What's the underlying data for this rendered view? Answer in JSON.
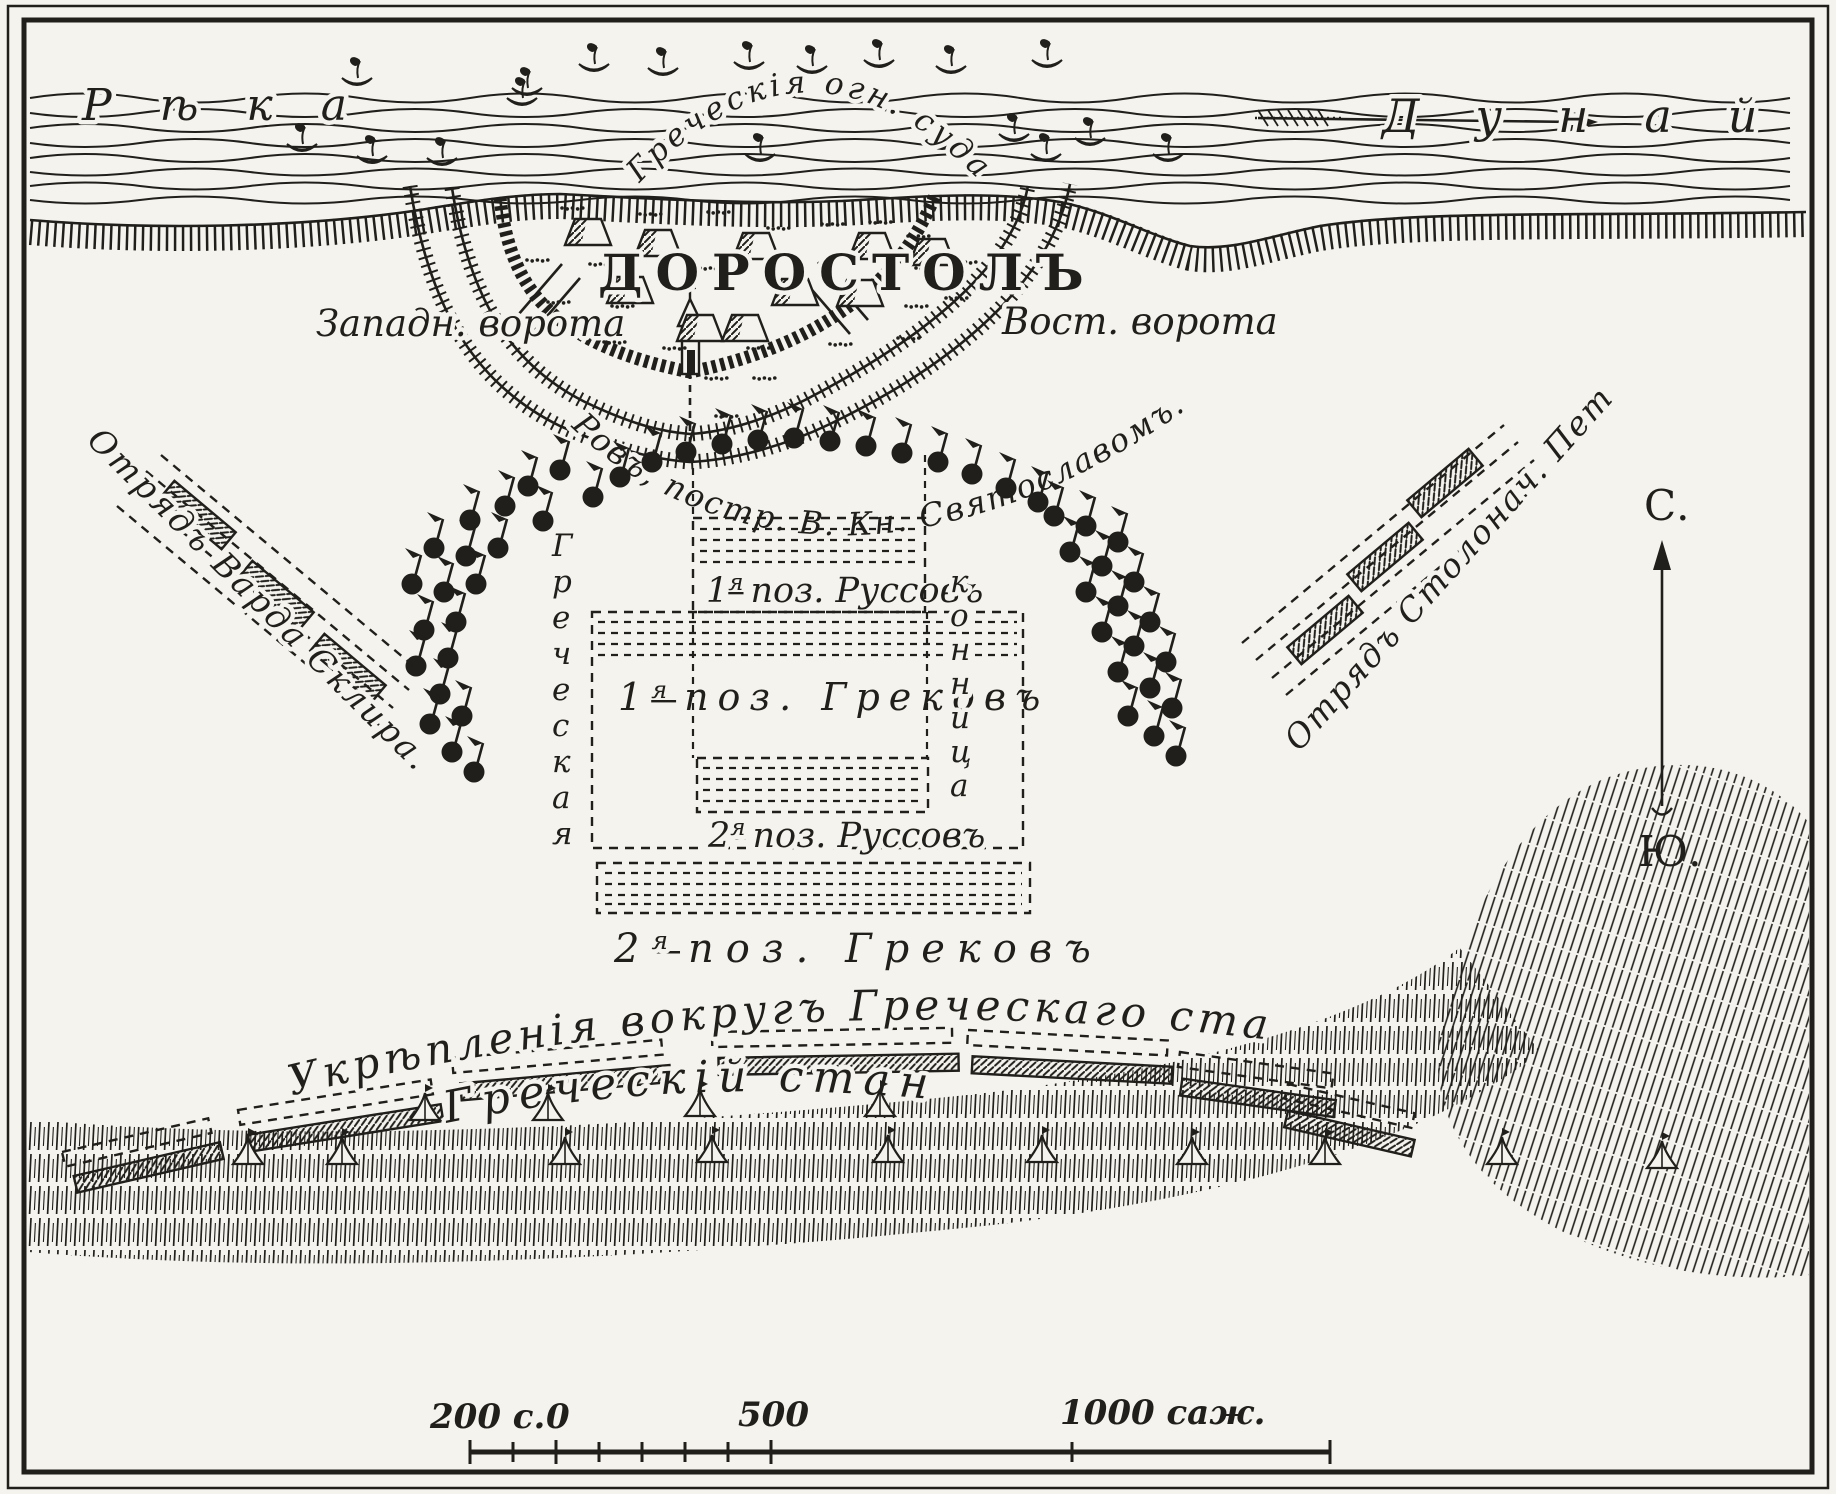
{
  "map": {
    "river": {
      "left_name": "Рѣка",
      "right_name": "Дунай",
      "ships_label": "Греческія огн. суда"
    },
    "city": {
      "name": "ДОРОСТОЛЪ",
      "west_gate": "Западн. ворота",
      "east_gate": "Вост. ворота",
      "moat_label": "Ровъ, постр. В. Кн. Святославомъ."
    },
    "positions": {
      "rus1": {
        "num": "1",
        "sup": "я",
        "text": "поз. Руссовъ"
      },
      "greek1": {
        "num": "1",
        "sup": "я",
        "text": "поз. Грековъ"
      },
      "rus2": {
        "num": "2",
        "sup": "я",
        "text": "поз. Руссовъ"
      },
      "greek2": {
        "num": "2",
        "sup": "я",
        "text": "поз. Грековъ"
      }
    },
    "cavalry": {
      "left_word": "Греческая",
      "right_word": "конница"
    },
    "detachments": {
      "left": "Отрядъ Варда Склира.",
      "right": "Отрядъ Столонач. Петра."
    },
    "fortifications_label": "Укрѣпленія вокругъ Греческаго стана",
    "camp_label": "Греческій станъ",
    "compass": {
      "north": "С.",
      "south": "Ю."
    },
    "scale": {
      "left": "200 с.",
      "zero": "0",
      "mid": "500",
      "right": "1000 саж."
    },
    "colors": {
      "paper": "#f5f3ed",
      "ink": "#211f1b"
    }
  }
}
